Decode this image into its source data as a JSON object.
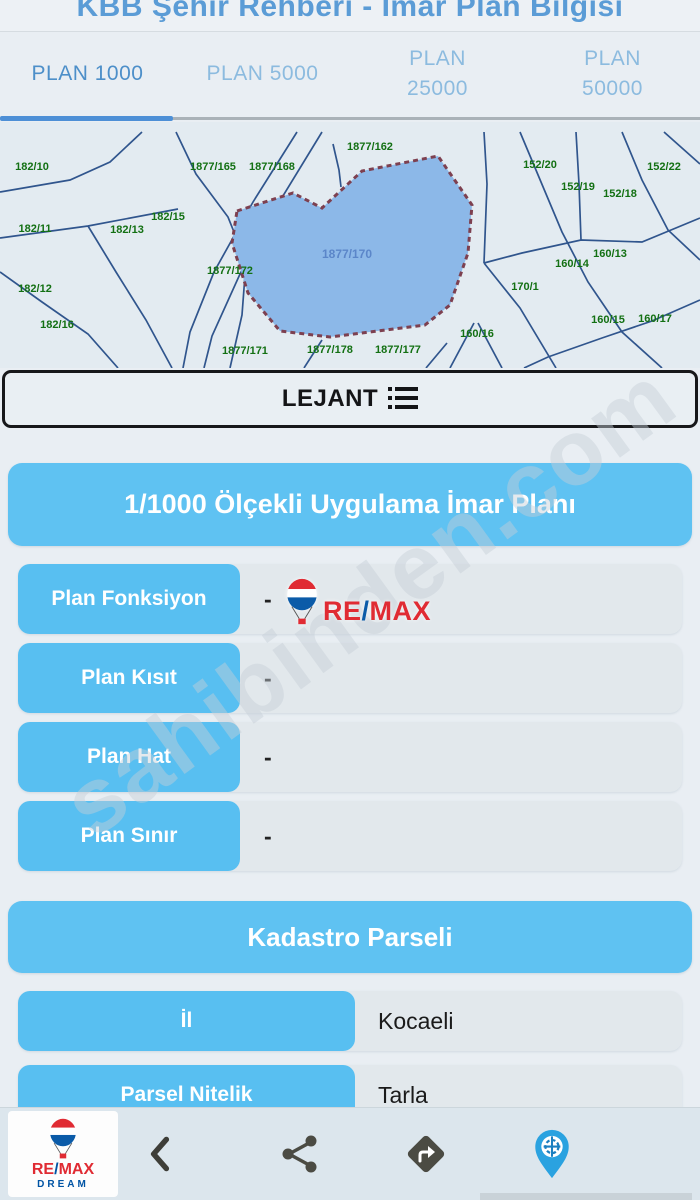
{
  "header": {
    "title": "KBB Şehir Rehberi - İmar Plan Bilgisi"
  },
  "tabs": [
    {
      "label": "PLAN 1000",
      "active": true,
      "two_line": false
    },
    {
      "label": "PLAN 5000",
      "active": false,
      "two_line": false
    },
    {
      "label": "PLAN 25000",
      "active": false,
      "two_line": true
    },
    {
      "label": "PLAN 50000",
      "active": false,
      "two_line": true
    }
  ],
  "legend_button": {
    "label": "LEJANT"
  },
  "map": {
    "selected_parcel": {
      "label": "1877/170",
      "points": "237,89 293,71 322,86 362,49 438,34 472,83 468,131 450,183 425,203 330,215 280,209 248,171 232,121",
      "label_x": 347,
      "label_y": 136
    },
    "lines": [
      "0,116 88,104 178,87",
      "176,10 196,52 228,95 246,140 242,193 230,246",
      "88,104 116,150 146,198 172,246",
      "0,150 42,180 88,212 118,246",
      "142,10 110,40 70,58 0,70",
      "333,22 339,48 341,65",
      "297,10 253,80 214,150 190,210 183,246",
      "322,10 278,82 240,152 212,214 204,246",
      "520,10 541,60 562,110 588,160 622,210 662,246",
      "576,10 579,62 581,118",
      "622,10 642,58 668,108 700,138",
      "700,96 642,120 581,118 522,131 484,141",
      "484,141 520,186 556,246",
      "484,10 487,62 484,141",
      "700,178 652,199 602,216 548,235 524,246",
      "664,10 700,42",
      "450,246 474,201",
      "478,201 502,246",
      "304,246 322,218",
      "426,246 447,221"
    ],
    "labels": [
      {
        "t": "182/10",
        "x": 32,
        "y": 48
      },
      {
        "t": "182/11",
        "x": 35,
        "y": 110
      },
      {
        "t": "182/13",
        "x": 127,
        "y": 111
      },
      {
        "t": "182/15",
        "x": 168,
        "y": 98
      },
      {
        "t": "1877/165",
        "x": 213,
        "y": 48
      },
      {
        "t": "1877/168",
        "x": 272,
        "y": 48
      },
      {
        "t": "1877/162",
        "x": 370,
        "y": 28
      },
      {
        "t": "182/12",
        "x": 35,
        "y": 170
      },
      {
        "t": "182/16",
        "x": 57,
        "y": 206
      },
      {
        "t": "1877/172",
        "x": 230,
        "y": 152
      },
      {
        "t": "1877/171",
        "x": 245,
        "y": 232
      },
      {
        "t": "1877/178",
        "x": 330,
        "y": 231
      },
      {
        "t": "1877/177",
        "x": 398,
        "y": 231
      },
      {
        "t": "160/16",
        "x": 477,
        "y": 215
      },
      {
        "t": "152/20",
        "x": 540,
        "y": 46
      },
      {
        "t": "152/19",
        "x": 578,
        "y": 68
      },
      {
        "t": "152/18",
        "x": 620,
        "y": 75
      },
      {
        "t": "152/22",
        "x": 664,
        "y": 48
      },
      {
        "t": "160/13",
        "x": 610,
        "y": 135
      },
      {
        "t": "160/14",
        "x": 572,
        "y": 145
      },
      {
        "t": "170/1",
        "x": 525,
        "y": 168
      },
      {
        "t": "160/15",
        "x": 608,
        "y": 201
      },
      {
        "t": "160/17",
        "x": 655,
        "y": 200
      }
    ],
    "colors": {
      "line": "#30558d",
      "parcel_fill": "#8cb8e8",
      "parcel_border": "#7d4050",
      "label": "#137013",
      "parcel_label": "#5b86c9"
    }
  },
  "sections": [
    {
      "title": "1/1000 Ölçekli Uygulama İmar Planı",
      "rows": [
        {
          "label": "Plan Fonksiyon",
          "value": "-"
        },
        {
          "label": "Plan Kısıt",
          "value": "-"
        },
        {
          "label": "Plan Hat",
          "value": "-"
        },
        {
          "label": "Plan Sınır",
          "value": "-"
        }
      ]
    },
    {
      "title": "Kadastro Parseli",
      "rows": [
        {
          "label": "İl",
          "value": "Kocaeli"
        },
        {
          "label": "Parsel Nitelik",
          "value": "Tarla"
        }
      ]
    }
  ],
  "watermark": {
    "text": "sahibinden.com",
    "brand_wordmark": "RE/MAX"
  },
  "footer": {
    "logo_wordmark": "RE/MAX",
    "logo_sub": "DREAM",
    "icons": [
      "back",
      "share",
      "directions",
      "location"
    ]
  },
  "colors": {
    "accent_blue": "#5fc2f2",
    "row_label_blue": "#58bff1",
    "tab_active": "#4d8fc9",
    "tab_inactive": "#8cbbdf",
    "remax_red": "#e11b22",
    "remax_blue": "#0054a4",
    "pin_blue": "#2aa2e0"
  }
}
